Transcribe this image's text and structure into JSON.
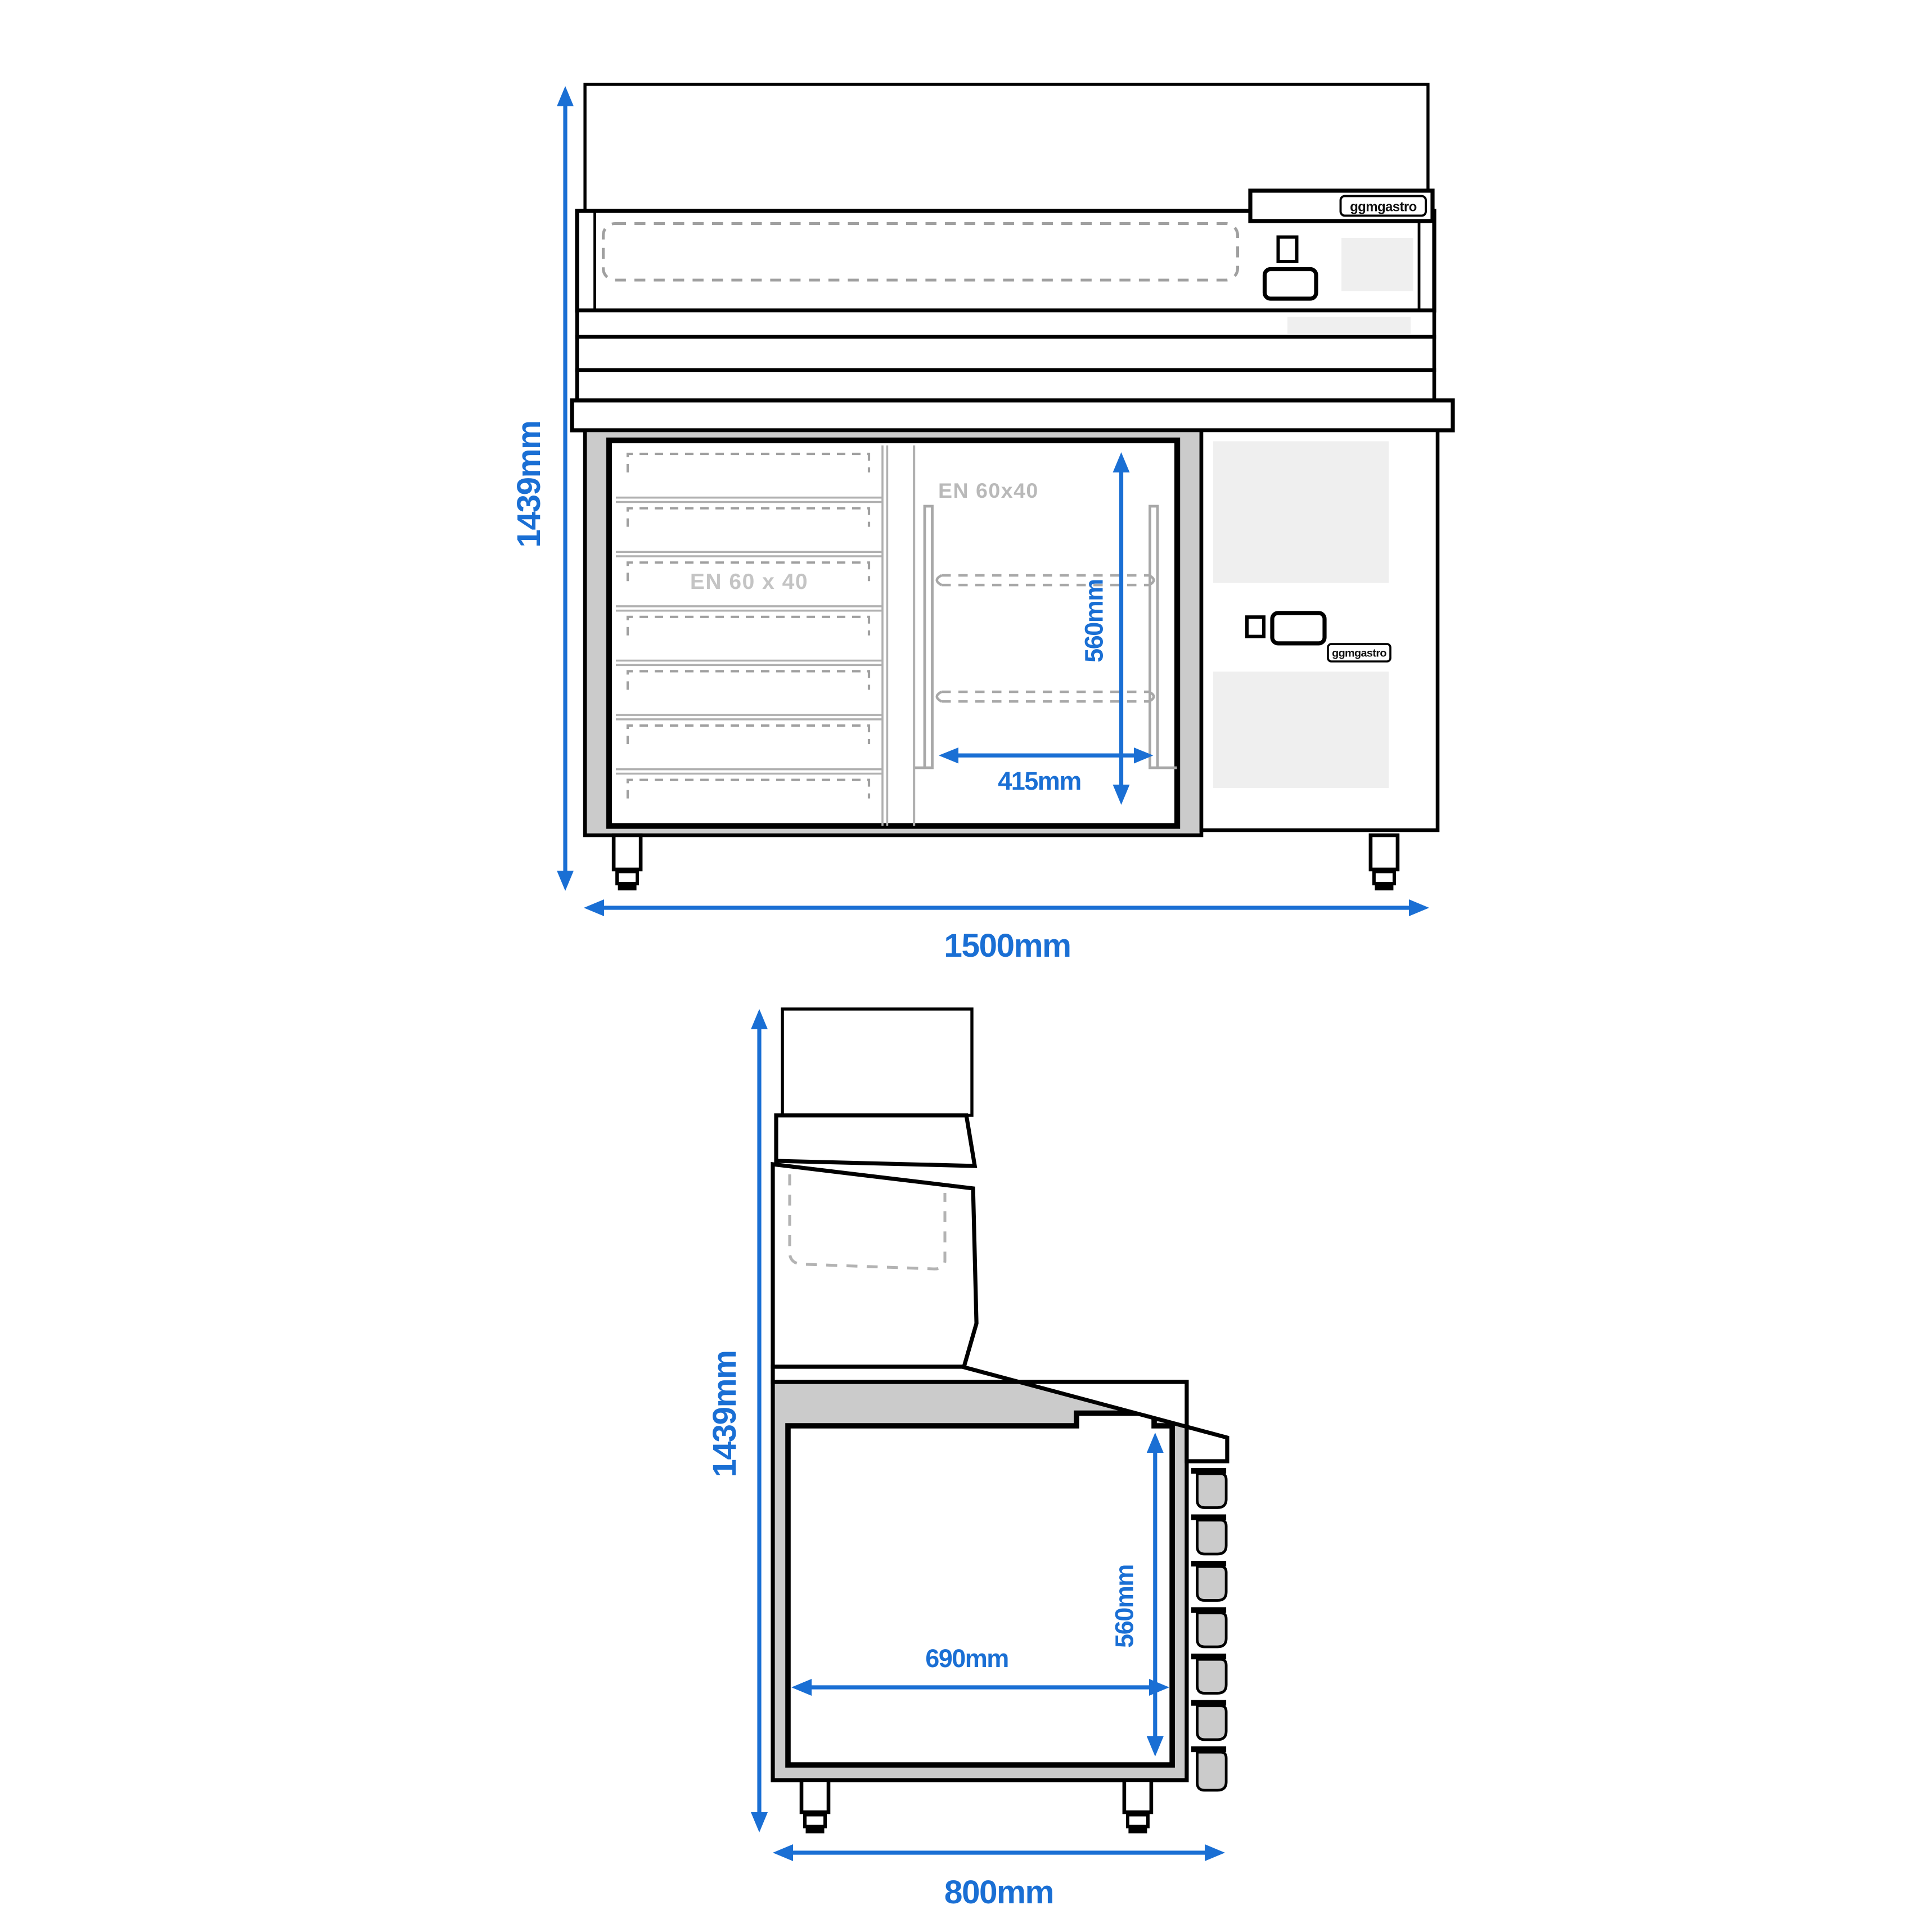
{
  "colors": {
    "accent_blue": "#1a6fd4",
    "cabinet_gray": "#cbcbcb",
    "panel_gray": "#efefef",
    "dash_gray": "#a0a0a0",
    "label_gray": "#bfbfbf"
  },
  "brand": {
    "name": "ggmgastro"
  },
  "front_view": {
    "overall_height": "1439mm",
    "overall_width": "1500mm",
    "compartment_height": "560mm",
    "compartment_width": "415mm",
    "drawer_standard": "EN 60 x 40",
    "compartment_standard": "EN 60x40",
    "logo_top": "ggmgastro",
    "logo_panel": "ggmgastro"
  },
  "side_view": {
    "overall_height": "1439mm",
    "overall_depth": "800mm",
    "interior_depth": "690mm",
    "interior_height": "560mm"
  }
}
